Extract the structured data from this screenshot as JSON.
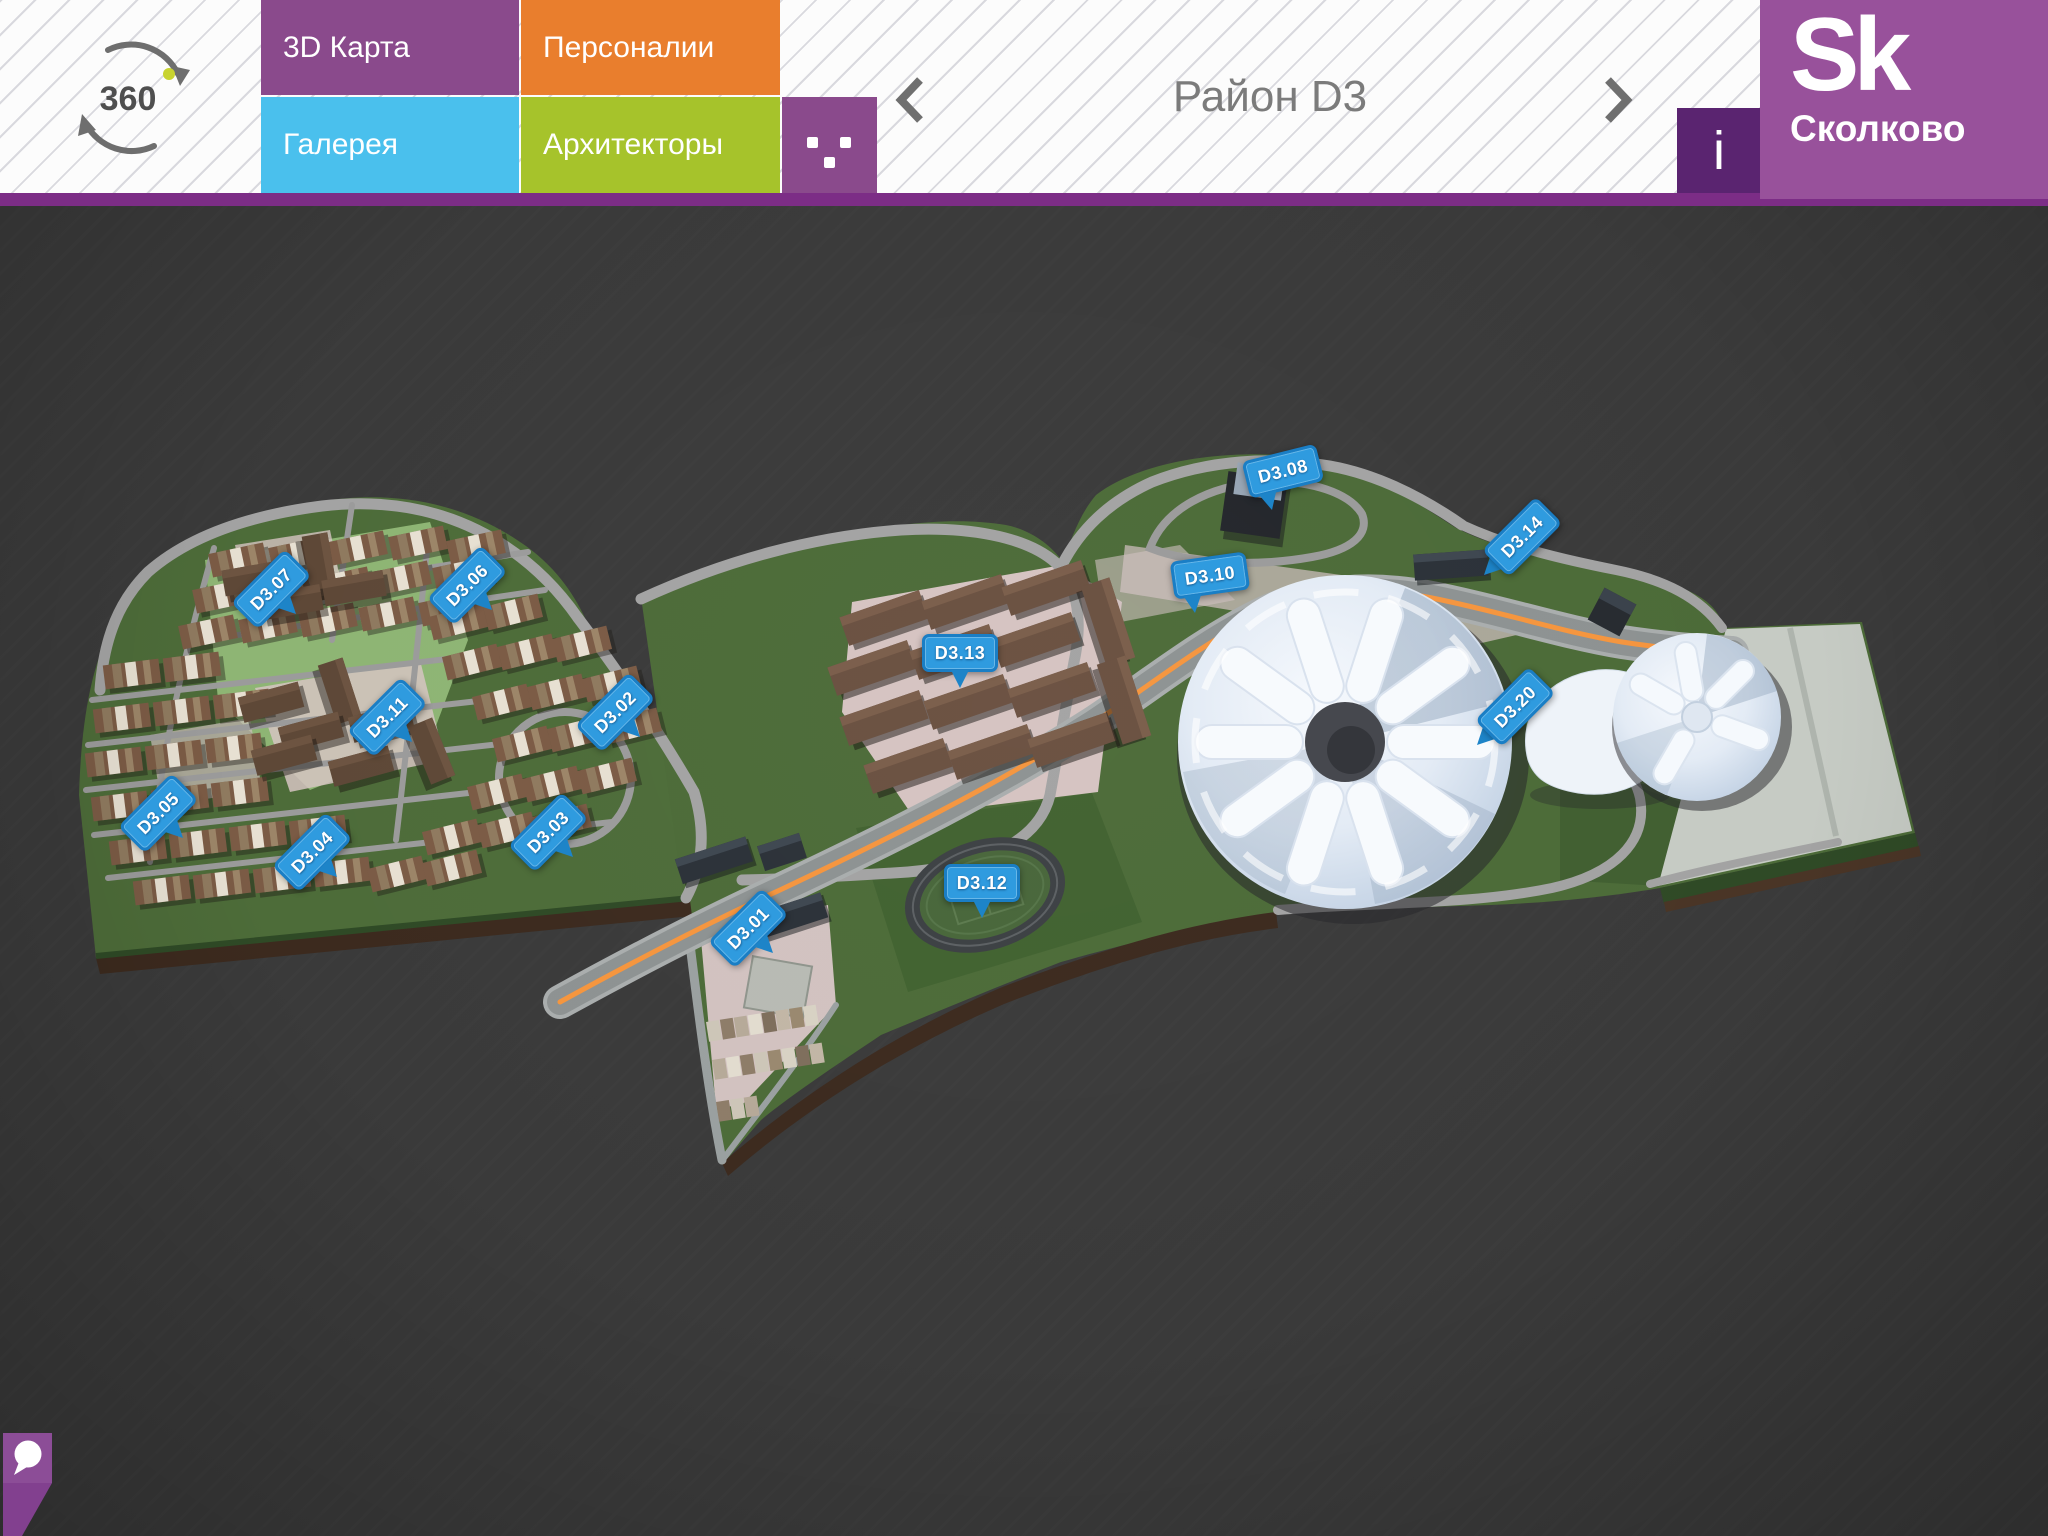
{
  "header": {
    "rotate_badge": {
      "label": "360"
    },
    "tabs": [
      {
        "label": "3D Карта",
        "color": "#8a4a8c"
      },
      {
        "label": "Галерея",
        "color": "#4ac0ed"
      },
      {
        "label": "Персоналии",
        "color": "#e97e2d"
      },
      {
        "label": "Архитекторы",
        "color": "#a6c32b"
      }
    ],
    "nav": {
      "title": "Район D3"
    },
    "info_button": {
      "label": "i"
    },
    "logo": {
      "mark": "Sk",
      "name": "Сколково"
    }
  },
  "map": {
    "district": "D3",
    "pin_color": "#1d84c8",
    "pin_inner_color": "#2f9bdf",
    "pins": [
      {
        "label": "D3.01",
        "x": 773,
        "y": 953,
        "angle": -45,
        "variant": "bottom"
      },
      {
        "label": "D3.02",
        "x": 640,
        "y": 737,
        "angle": -45,
        "variant": "bottom"
      },
      {
        "label": "D3.03",
        "x": 573,
        "y": 857,
        "angle": -45,
        "variant": "bottom"
      },
      {
        "label": "D3.04",
        "x": 337,
        "y": 877,
        "angle": -45,
        "variant": "bottom"
      },
      {
        "label": "D3.05",
        "x": 183,
        "y": 838,
        "angle": -45,
        "variant": "bottom"
      },
      {
        "label": "D3.06",
        "x": 492,
        "y": 610,
        "angle": -45,
        "variant": "bottom"
      },
      {
        "label": "D3.07",
        "x": 296,
        "y": 614,
        "angle": -45,
        "variant": "bottom"
      },
      {
        "label": "D3.08",
        "x": 1272,
        "y": 510,
        "angle": -14,
        "variant": "bottom-left"
      },
      {
        "label": "D3.10",
        "x": 1195,
        "y": 613,
        "angle": -8,
        "variant": "bottom-left"
      },
      {
        "label": "D3.11",
        "x": 412,
        "y": 742,
        "angle": -45,
        "variant": "bottom"
      },
      {
        "label": "D3.12",
        "x": 982,
        "y": 918,
        "angle": 0,
        "variant": "bottom"
      },
      {
        "label": "D3.13",
        "x": 960,
        "y": 688,
        "angle": 0,
        "variant": "bottom"
      },
      {
        "label": "D3.14",
        "x": 1484,
        "y": 575,
        "angle": -45,
        "variant": "side"
      },
      {
        "label": "D3.20",
        "x": 1477,
        "y": 745,
        "angle": -45,
        "variant": "side"
      }
    ]
  },
  "footer": {
    "chat_icon": "speech-bubble-icon"
  }
}
